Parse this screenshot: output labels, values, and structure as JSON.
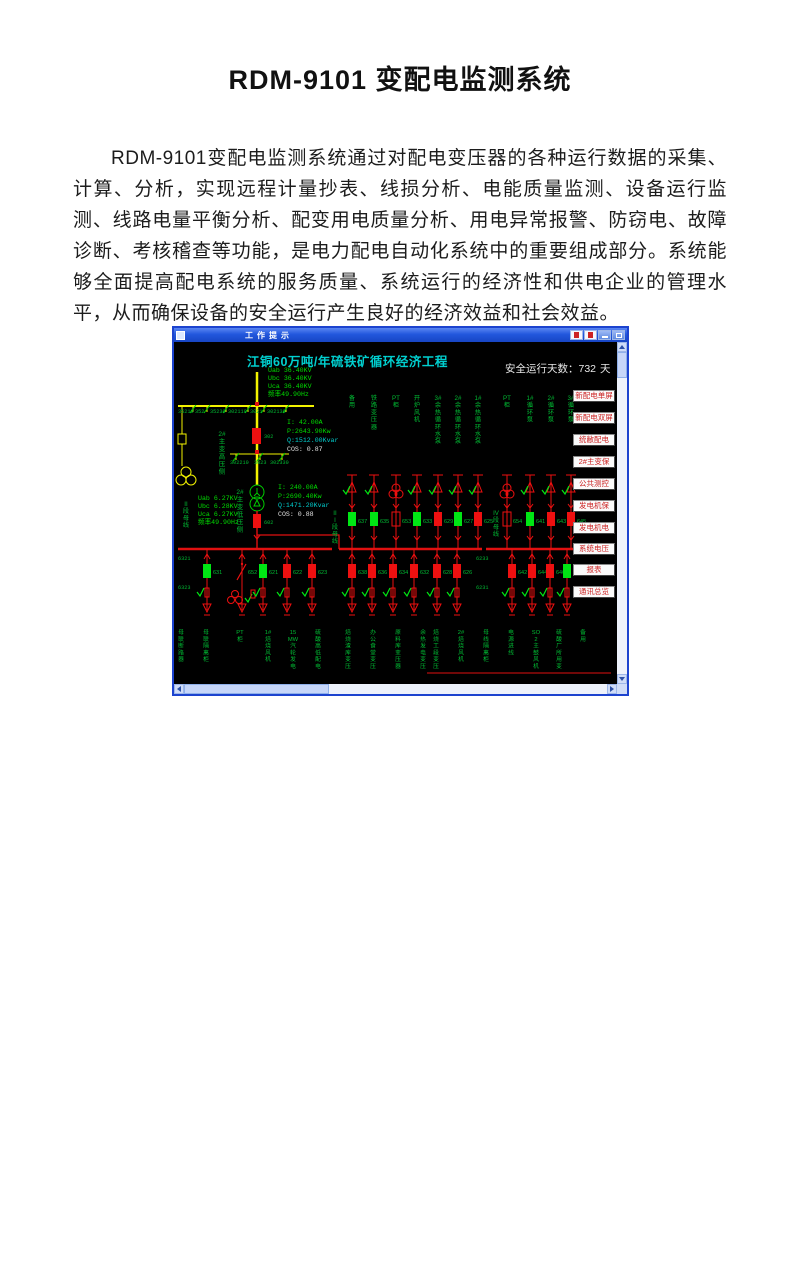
{
  "page": {
    "title": "RDM-9101 变配电监测系统",
    "paragraph": "RDM-9101变配电监测系统通过对配电变压器的各种运行数据的采集、计算、分析，实现远程计量抄表、线损分析、电能质量监测、设备运行监测、线路电量平衡分析、配变用电质量分析、用电异常报警、防窃电、故障诊断、考核稽查等功能，是电力配电自动化系统中的重要组成部分。系统能够全面提高配电系统的服务质量、系统运行的经济性和供电企业的管理水平，从而确保设备的安全运行产生良好的经济效益和社会效益。"
  },
  "window": {
    "title": "工作提示",
    "menu_items": [
      "新配电单屏",
      "新配电双屏",
      "统敝配电",
      "2#主变保",
      "公共测控",
      "发电机保",
      "发电机电",
      "系统电压",
      "报表",
      "通讯总览"
    ],
    "scada": {
      "diagram_title": "江铜60万吨/年硫铁矿循环经济工程",
      "safe_days_label": "安全运行天数：",
      "safe_days_value": "732",
      "safe_days_unit": "天",
      "hv_voltages": [
        "Uab 36.40KV",
        "Ubc 36.40KV",
        "Uca 36.40KV",
        "频率49.90Hz"
      ],
      "hv_switch_labels": [
        "35210",
        "352",
        "35230",
        "302110",
        "3021",
        "302130"
      ],
      "hv_lower_labels": [
        "302210",
        "3023",
        "302330"
      ],
      "hv_breaker_id": "302",
      "lv_breaker_id": "602",
      "hv_side_label": "2#主变高压侧",
      "lv_side_label": "2#主变低压侧",
      "hv_metering": [
        "I:  42.00A",
        "P:2643.90Kw",
        "Q:1512.00Kvar",
        "COS:  0.87"
      ],
      "lv_metering": [
        "I: 240.00A",
        "P:2690.40Kw",
        "Q:1471.20Kvar",
        "COS:  0.88"
      ],
      "lv_voltages": [
        "Uab 6.27KV",
        "Ubc 6.28KV",
        "Uca 6.27KV",
        "频率49.90Hz"
      ],
      "bus_labels": [
        "II 段母线",
        "III 段母线",
        "IV 段母线"
      ],
      "bus_tags": [
        "6321",
        "6323",
        "6233",
        "6231"
      ],
      "top_feeder_names": [
        "备用",
        "铁路变压器",
        "PT柜",
        "开炉风机",
        "3#余热循环水泵",
        "2#余热循环水泵",
        "1#余热循环水泵",
        "PT柜",
        "1#循环泵",
        "2#循环泵",
        "3#循环泵"
      ],
      "top_feeders": [
        {
          "id": "637",
          "state": "closed"
        },
        {
          "id": "635",
          "state": "closed"
        },
        {
          "id": "653",
          "state": "trans"
        },
        {
          "id": "633",
          "state": "closed"
        },
        {
          "id": "629",
          "state": "open"
        },
        {
          "id": "627",
          "state": "closed"
        },
        {
          "id": "625",
          "state": "open"
        },
        {
          "id": "654",
          "state": "trans"
        },
        {
          "id": "641",
          "state": "closed"
        },
        {
          "id": "643",
          "state": "open"
        },
        {
          "id": "645",
          "state": "open"
        }
      ],
      "bottom_feeders": [
        {
          "id": "631",
          "state": "closed"
        },
        {
          "id": "652",
          "state": "tie"
        },
        {
          "id": "621",
          "state": "closed"
        },
        {
          "id": "622",
          "state": "open"
        },
        {
          "id": "623",
          "state": "open"
        },
        {
          "id": "638",
          "state": "open"
        },
        {
          "id": "636",
          "state": "open"
        },
        {
          "id": "634",
          "state": "open"
        },
        {
          "id": "632",
          "state": "open"
        },
        {
          "id": "628",
          "state": "open"
        },
        {
          "id": "626",
          "state": "open"
        },
        {
          "id": "642",
          "state": "open"
        },
        {
          "id": "644",
          "state": "open"
        },
        {
          "id": "646",
          "state": "open"
        },
        {
          "id": "648",
          "state": "closed"
        }
      ],
      "bottom_feeder_names": [
        "母联断路器",
        "母联隔离柜",
        "PT柜",
        "1#焙烧风机",
        "15MW汽轮发电",
        "硫酸高低配电",
        "焙烧渣库变压",
        "办公食堂变压",
        "原料库变压器",
        "余热发电变压",
        "焙烧工段变压",
        "2#焙烧风机",
        "母线隔离柜",
        "电源进线",
        "SO2主鼓风机",
        "硫酸厂所用变",
        "备用"
      ],
      "colors": {
        "closed": "#00e614",
        "open": "#ee1010",
        "bus": "#e01010",
        "hv_bus": "#f2f200",
        "label_green": "#00bb33",
        "title_cyan": "#00cfcf",
        "metering_cyan": "#00cccc",
        "white": "#e8e8e8"
      }
    }
  }
}
